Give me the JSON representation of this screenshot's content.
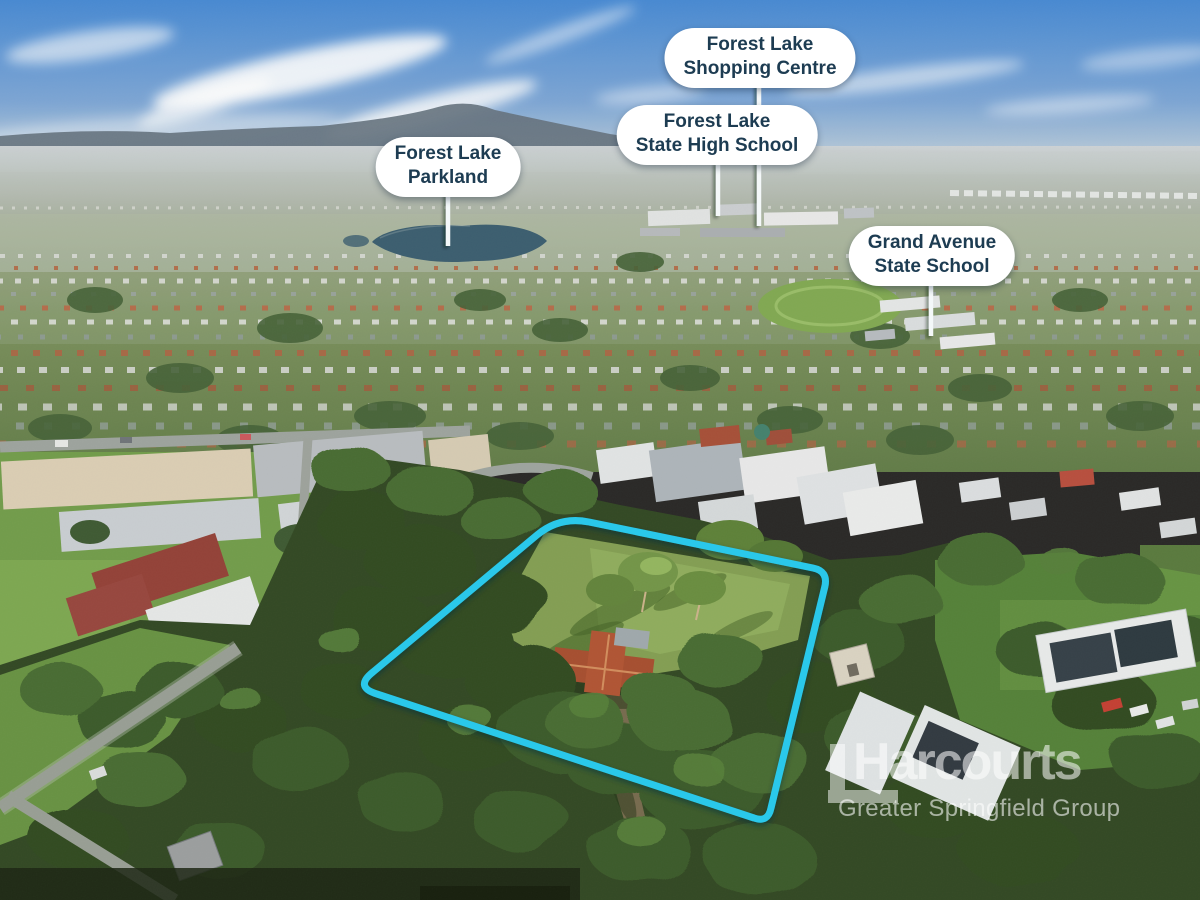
{
  "image": {
    "type": "aerial-photograph",
    "subject": "suburban property with highlighted boundary"
  },
  "callouts": {
    "shopping_centre": {
      "line1": "Forest Lake",
      "line2": "Shopping Centre"
    },
    "high_school": {
      "line1": "Forest Lake",
      "line2": "State High School"
    },
    "parkland": {
      "line1": "Forest Lake",
      "line2": "Parkland"
    },
    "grand_avenue": {
      "line1": "Grand Avenue",
      "line2": "State School"
    }
  },
  "watermark": {
    "brand": "Harcourts",
    "subtitle": "Greater Springfield Group"
  },
  "colors": {
    "boundary": "#2AC8EA",
    "callout_bg": "#FFFFFF",
    "callout_text": "#1D3C52",
    "pointer_line": "#F4F8F9"
  }
}
